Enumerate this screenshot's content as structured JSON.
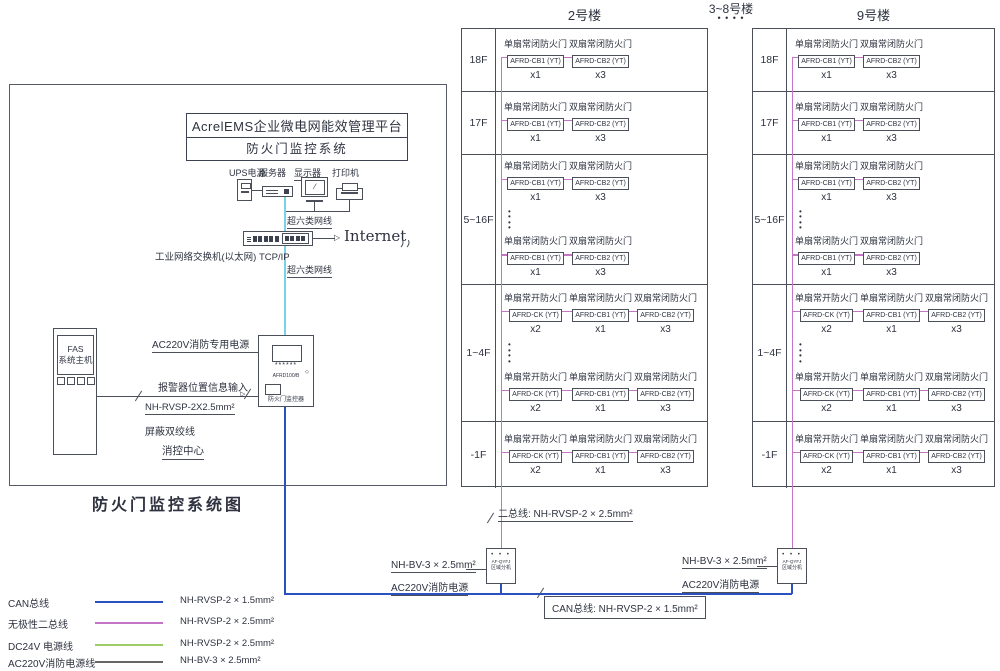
{
  "diagram_title": "防火门监控系统图",
  "platform": {
    "line1": "AcrelEMS企业微电网能效管理平台",
    "line2": "防火门监控系统"
  },
  "devices": {
    "ups": "UPS电源",
    "server": "服务器",
    "monitor": "显示器",
    "printer": "打印机"
  },
  "network": {
    "cable_top": "超六类网线",
    "cable_bottom": "超六类网线",
    "switch": "工业网络交换机(以太网) TCP/IP",
    "internet": "Internet"
  },
  "fas": {
    "line1": "FAS",
    "line2": "系统主机"
  },
  "controller": {
    "model": "AFRD100/B",
    "name": "防火门监控器",
    "leds": "******",
    "indicator": "◇"
  },
  "labels": {
    "dedicated_power": "AC220V消防专用电源",
    "alarm_input": "报警器位置信息输入",
    "shielded_wire_spec": "NH-RVSP-2X2.5mm²",
    "shielded_wire_name": "屏蔽双绞线",
    "control_center": "消控中心",
    "two_bus": "二总线: NH-RVSP-2 × 2.5mm²",
    "can_bus": "CAN总线: NH-RVSP-2 × 1.5mm²"
  },
  "extension": {
    "model": "AF-QYFJ",
    "name": "区域分机",
    "dots": "• • •",
    "power_spec": "NH-BV-3 × 2.5mm²",
    "power_name": "AC220V消防电源"
  },
  "headers": {
    "building_left": "2号楼",
    "building_middle": "3~8号楼",
    "middle_dots": "• • • •",
    "building_right": "9号楼"
  },
  "icons": {
    "arrow_right": "▷"
  },
  "colors": {
    "two_bus_pink": "#c575c5",
    "can_bus_blue": "#2b50c0",
    "network_cyan": "#7ad1e6",
    "dc24v_green": "#9ccc66",
    "ac220v_gray": "#666666"
  },
  "legend": [
    {
      "label": "CAN总线",
      "spec": "NH-RVSP-2 × 1.5mm²",
      "color": "#2b50c0"
    },
    {
      "label": "无极性二总线",
      "spec": "NH-RVSP-2 × 2.5mm²",
      "color": "#c575c5"
    },
    {
      "label": "DC24V 电源线",
      "spec": "NH-RVSP-2 × 2.5mm²",
      "color": "#9ccc66"
    },
    {
      "label": "AC220V消防电源线",
      "spec": "NH-BV-3 × 2.5mm²",
      "color": "#666666"
    }
  ],
  "buildings": [
    {
      "name": "2号楼",
      "floors": [
        {
          "label": "18F",
          "dots": false,
          "groups": [
            [
              {
                "door": "单扇常闭防火门",
                "model": "AFRD-CB1 (YT)",
                "count": "x1"
              },
              {
                "door": "双扇常闭防火门",
                "model": "AFRD-CB2 (YT)",
                "count": "x3"
              }
            ]
          ]
        },
        {
          "label": "17F",
          "dots": false,
          "groups": [
            [
              {
                "door": "单扇常闭防火门",
                "model": "AFRD-CB1 (YT)",
                "count": "x1"
              },
              {
                "door": "双扇常闭防火门",
                "model": "AFRD-CB2 (YT)",
                "count": "x3"
              }
            ]
          ]
        },
        {
          "label": "5~16F",
          "dots": true,
          "groups": [
            [
              {
                "door": "单扇常闭防火门",
                "model": "AFRD-CB1 (YT)",
                "count": "x1"
              },
              {
                "door": "双扇常闭防火门",
                "model": "AFRD-CB2 (YT)",
                "count": "x3"
              }
            ],
            [
              {
                "door": "单扇常闭防火门",
                "model": "AFRD-CB1 (YT)",
                "count": "x1"
              },
              {
                "door": "双扇常闭防火门",
                "model": "AFRD-CB2 (YT)",
                "count": "x3"
              }
            ]
          ]
        },
        {
          "label": "1~4F",
          "dots": true,
          "groups": [
            [
              {
                "door": "单扇常开防火门",
                "model": "AFRD-CK (YT)",
                "count": "x2"
              },
              {
                "door": "单扇常闭防火门",
                "model": "AFRD-CB1 (YT)",
                "count": "x1"
              },
              {
                "door": "双扇常闭防火门",
                "model": "AFRD-CB2 (YT)",
                "count": "x3"
              }
            ],
            [
              {
                "door": "单扇常开防火门",
                "model": "AFRD-CK (YT)",
                "count": "x2"
              },
              {
                "door": "单扇常闭防火门",
                "model": "AFRD-CB1 (YT)",
                "count": "x1"
              },
              {
                "door": "双扇常闭防火门",
                "model": "AFRD-CB2 (YT)",
                "count": "x3"
              }
            ]
          ]
        },
        {
          "label": "-1F",
          "dots": false,
          "groups": [
            [
              {
                "door": "单扇常开防火门",
                "model": "AFRD-CK (YT)",
                "count": "x2"
              },
              {
                "door": "单扇常闭防火门",
                "model": "AFRD-CB1 (YT)",
                "count": "x1"
              },
              {
                "door": "双扇常闭防火门",
                "model": "AFRD-CB2 (YT)",
                "count": "x3"
              }
            ]
          ]
        }
      ]
    },
    {
      "name": "9号楼",
      "floors": [
        {
          "label": "18F",
          "dots": false,
          "groups": [
            [
              {
                "door": "单扇常闭防火门",
                "model": "AFRD-CB1 (YT)",
                "count": "x1"
              },
              {
                "door": "双扇常闭防火门",
                "model": "AFRD-CB2 (YT)",
                "count": "x3"
              }
            ]
          ]
        },
        {
          "label": "17F",
          "dots": false,
          "groups": [
            [
              {
                "door": "单扇常闭防火门",
                "model": "AFRD-CB1 (YT)",
                "count": "x1"
              },
              {
                "door": "双扇常闭防火门",
                "model": "AFRD-CB2 (YT)",
                "count": "x3"
              }
            ]
          ]
        },
        {
          "label": "5~16F",
          "dots": true,
          "groups": [
            [
              {
                "door": "单扇常闭防火门",
                "model": "AFRD-CB1 (YT)",
                "count": "x1"
              },
              {
                "door": "双扇常闭防火门",
                "model": "AFRD-CB2 (YT)",
                "count": "x3"
              }
            ],
            [
              {
                "door": "单扇常闭防火门",
                "model": "AFRD-CB1 (YT)",
                "count": "x1"
              },
              {
                "door": "双扇常闭防火门",
                "model": "AFRD-CB2 (YT)",
                "count": "x3"
              }
            ]
          ]
        },
        {
          "label": "1~4F",
          "dots": true,
          "groups": [
            [
              {
                "door": "单扇常开防火门",
                "model": "AFRD-CK (YT)",
                "count": "x2"
              },
              {
                "door": "单扇常闭防火门",
                "model": "AFRD-CB1 (YT)",
                "count": "x1"
              },
              {
                "door": "双扇常闭防火门",
                "model": "AFRD-CB2 (YT)",
                "count": "x3"
              }
            ],
            [
              {
                "door": "单扇常开防火门",
                "model": "AFRD-CK (YT)",
                "count": "x2"
              },
              {
                "door": "单扇常闭防火门",
                "model": "AFRD-CB1 (YT)",
                "count": "x1"
              },
              {
                "door": "双扇常闭防火门",
                "model": "AFRD-CB2 (YT)",
                "count": "x3"
              }
            ]
          ]
        },
        {
          "label": "-1F",
          "dots": false,
          "groups": [
            [
              {
                "door": "单扇常开防火门",
                "model": "AFRD-CK (YT)",
                "count": "x2"
              },
              {
                "door": "单扇常闭防火门",
                "model": "AFRD-CB1 (YT)",
                "count": "x1"
              },
              {
                "door": "双扇常闭防火门",
                "model": "AFRD-CB2 (YT)",
                "count": "x3"
              }
            ]
          ]
        }
      ]
    }
  ]
}
